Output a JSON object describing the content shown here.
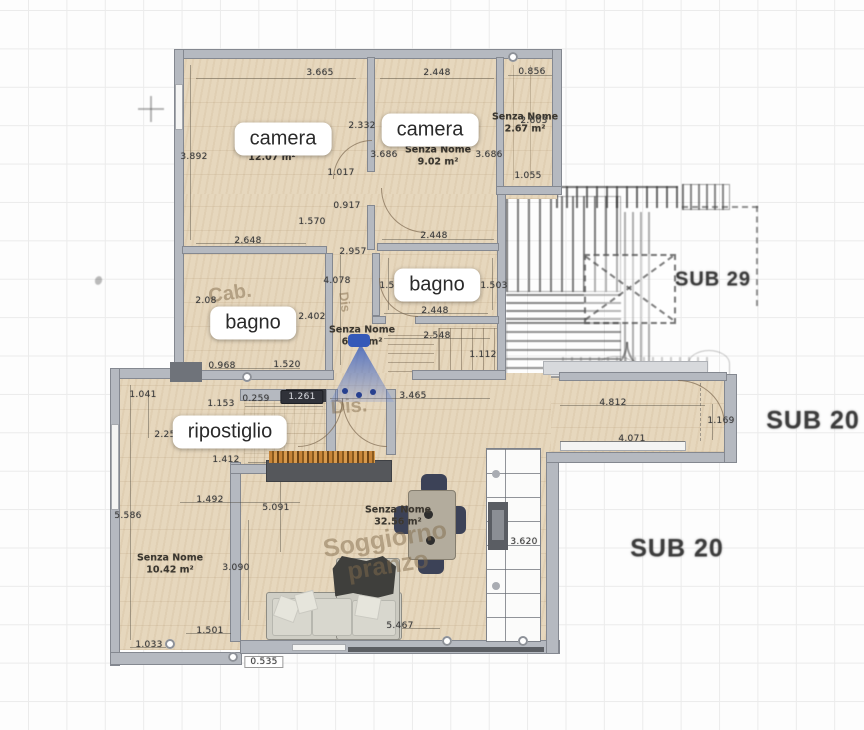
{
  "colors": {
    "wall_fill": "#b5b9c0",
    "wall_edge": "#848890",
    "floor_wood": "#e6d7bd",
    "pencil_sketch": "#4a4a4a",
    "camera_cone_blue": "#3a5fb8",
    "door_slab_dark": "#3a3c42",
    "label_pill_bg": "#ffffff",
    "dimension_text": "#3a3a3a"
  },
  "room_labels": [
    {
      "id": "camera-1",
      "t": "camera",
      "x": 283,
      "y": 139
    },
    {
      "id": "camera-2",
      "t": "camera",
      "x": 430,
      "y": 130
    },
    {
      "id": "bagno-2",
      "t": "bagno",
      "x": 437,
      "y": 285
    },
    {
      "id": "bagno-1",
      "t": "bagno",
      "x": 253,
      "y": 323
    },
    {
      "id": "ripostiglio",
      "t": "ripostiglio",
      "x": 230,
      "y": 432
    }
  ],
  "area_labels": [
    {
      "name": "Senza Nome",
      "area": "9.02 m²",
      "x": 438,
      "y": 157
    },
    {
      "name": "Senza Nome",
      "area": "2.67 m²",
      "x": 525,
      "y": 124
    },
    {
      "name": "Senza Nome",
      "area": "6.57 m²",
      "x": 362,
      "y": 337
    },
    {
      "name": "Senza Nome",
      "area": "10.42 m²",
      "x": 170,
      "y": 565
    },
    {
      "name": "Senza Nome",
      "area": "32.56 m²",
      "x": 398,
      "y": 517
    },
    {
      "name": "",
      "area": "12.07 m²",
      "x": 272,
      "y": 158
    }
  ],
  "sub_labels": [
    {
      "t": "SUB 29",
      "x": 713,
      "y": 280,
      "s": 20
    },
    {
      "t": "SUB 20",
      "x": 813,
      "y": 421,
      "s": 25
    },
    {
      "t": "SUB 20",
      "x": 677,
      "y": 549,
      "s": 25
    }
  ],
  "faded_texts": [
    {
      "t": "Cab.",
      "x": 230,
      "y": 294,
      "s": 20,
      "r": -8
    },
    {
      "t": "Dis.",
      "x": 349,
      "y": 407,
      "s": 20,
      "r": -4
    },
    {
      "t": "Dis",
      "x": 345,
      "y": 302,
      "s": 13,
      "r": 83
    },
    {
      "t": "Soggiorno",
      "x": 385,
      "y": 540,
      "s": 25,
      "r": -9
    },
    {
      "t": "pranzo",
      "x": 388,
      "y": 566,
      "s": 25,
      "r": -9
    }
  ],
  "dimension_labels": [
    {
      "t": "3.665",
      "x": 320,
      "y": 73
    },
    {
      "t": "2.448",
      "x": 437,
      "y": 73
    },
    {
      "t": "0.856",
      "x": 532,
      "y": 72
    },
    {
      "t": "2.332",
      "x": 362,
      "y": 126
    },
    {
      "t": "3.892",
      "x": 194,
      "y": 157
    },
    {
      "t": "3.686",
      "x": 384,
      "y": 155
    },
    {
      "t": "3.686",
      "x": 489,
      "y": 155
    },
    {
      "t": "1.017",
      "x": 341,
      "y": 173
    },
    {
      "t": "0.917",
      "x": 347,
      "y": 206
    },
    {
      "t": "1.570",
      "x": 312,
      "y": 222
    },
    {
      "t": "2.648",
      "x": 248,
      "y": 241
    },
    {
      "t": "2.448",
      "x": 434,
      "y": 236
    },
    {
      "t": "2.957",
      "x": 353,
      "y": 252
    },
    {
      "t": "4.078",
      "x": 337,
      "y": 281
    },
    {
      "t": "1.50",
      "x": 390,
      "y": 286
    },
    {
      "t": "1.503",
      "x": 494,
      "y": 286
    },
    {
      "t": "2.448",
      "x": 435,
      "y": 311
    },
    {
      "t": "2.08",
      "x": 206,
      "y": 301
    },
    {
      "t": "2.402",
      "x": 312,
      "y": 317
    },
    {
      "t": "2.548",
      "x": 437,
      "y": 336
    },
    {
      "t": "1.112",
      "x": 483,
      "y": 355
    },
    {
      "t": "0.968",
      "x": 222,
      "y": 366
    },
    {
      "t": "1.520",
      "x": 287,
      "y": 365
    },
    {
      "t": "2.603",
      "x": 534,
      "y": 121
    },
    {
      "t": "1.055",
      "x": 528,
      "y": 176
    },
    {
      "t": "1.041",
      "x": 143,
      "y": 395
    },
    {
      "t": "1.153",
      "x": 221,
      "y": 404
    },
    {
      "t": "0.259",
      "x": 256,
      "y": 399
    },
    {
      "t": "1.261",
      "x": 302,
      "y": 397,
      "v": "badge"
    },
    {
      "t": "3.465",
      "x": 413,
      "y": 396
    },
    {
      "t": "2.256",
      "x": 168,
      "y": 435
    },
    {
      "t": "1.412",
      "x": 226,
      "y": 460
    },
    {
      "t": "1.492",
      "x": 210,
      "y": 500
    },
    {
      "t": "5.091",
      "x": 276,
      "y": 508
    },
    {
      "t": "5.586",
      "x": 128,
      "y": 516
    },
    {
      "t": "3.090",
      "x": 236,
      "y": 568
    },
    {
      "t": "1.501",
      "x": 210,
      "y": 631
    },
    {
      "t": "1.033",
      "x": 149,
      "y": 645
    },
    {
      "t": "0.535",
      "x": 264,
      "y": 662,
      "v": "boxed"
    },
    {
      "t": "5.467",
      "x": 400,
      "y": 626
    },
    {
      "t": "3.620",
      "x": 524,
      "y": 542
    },
    {
      "t": "4.812",
      "x": 613,
      "y": 403
    },
    {
      "t": "1.169",
      "x": 721,
      "y": 421
    },
    {
      "t": "4.071",
      "x": 632,
      "y": 439
    }
  ]
}
